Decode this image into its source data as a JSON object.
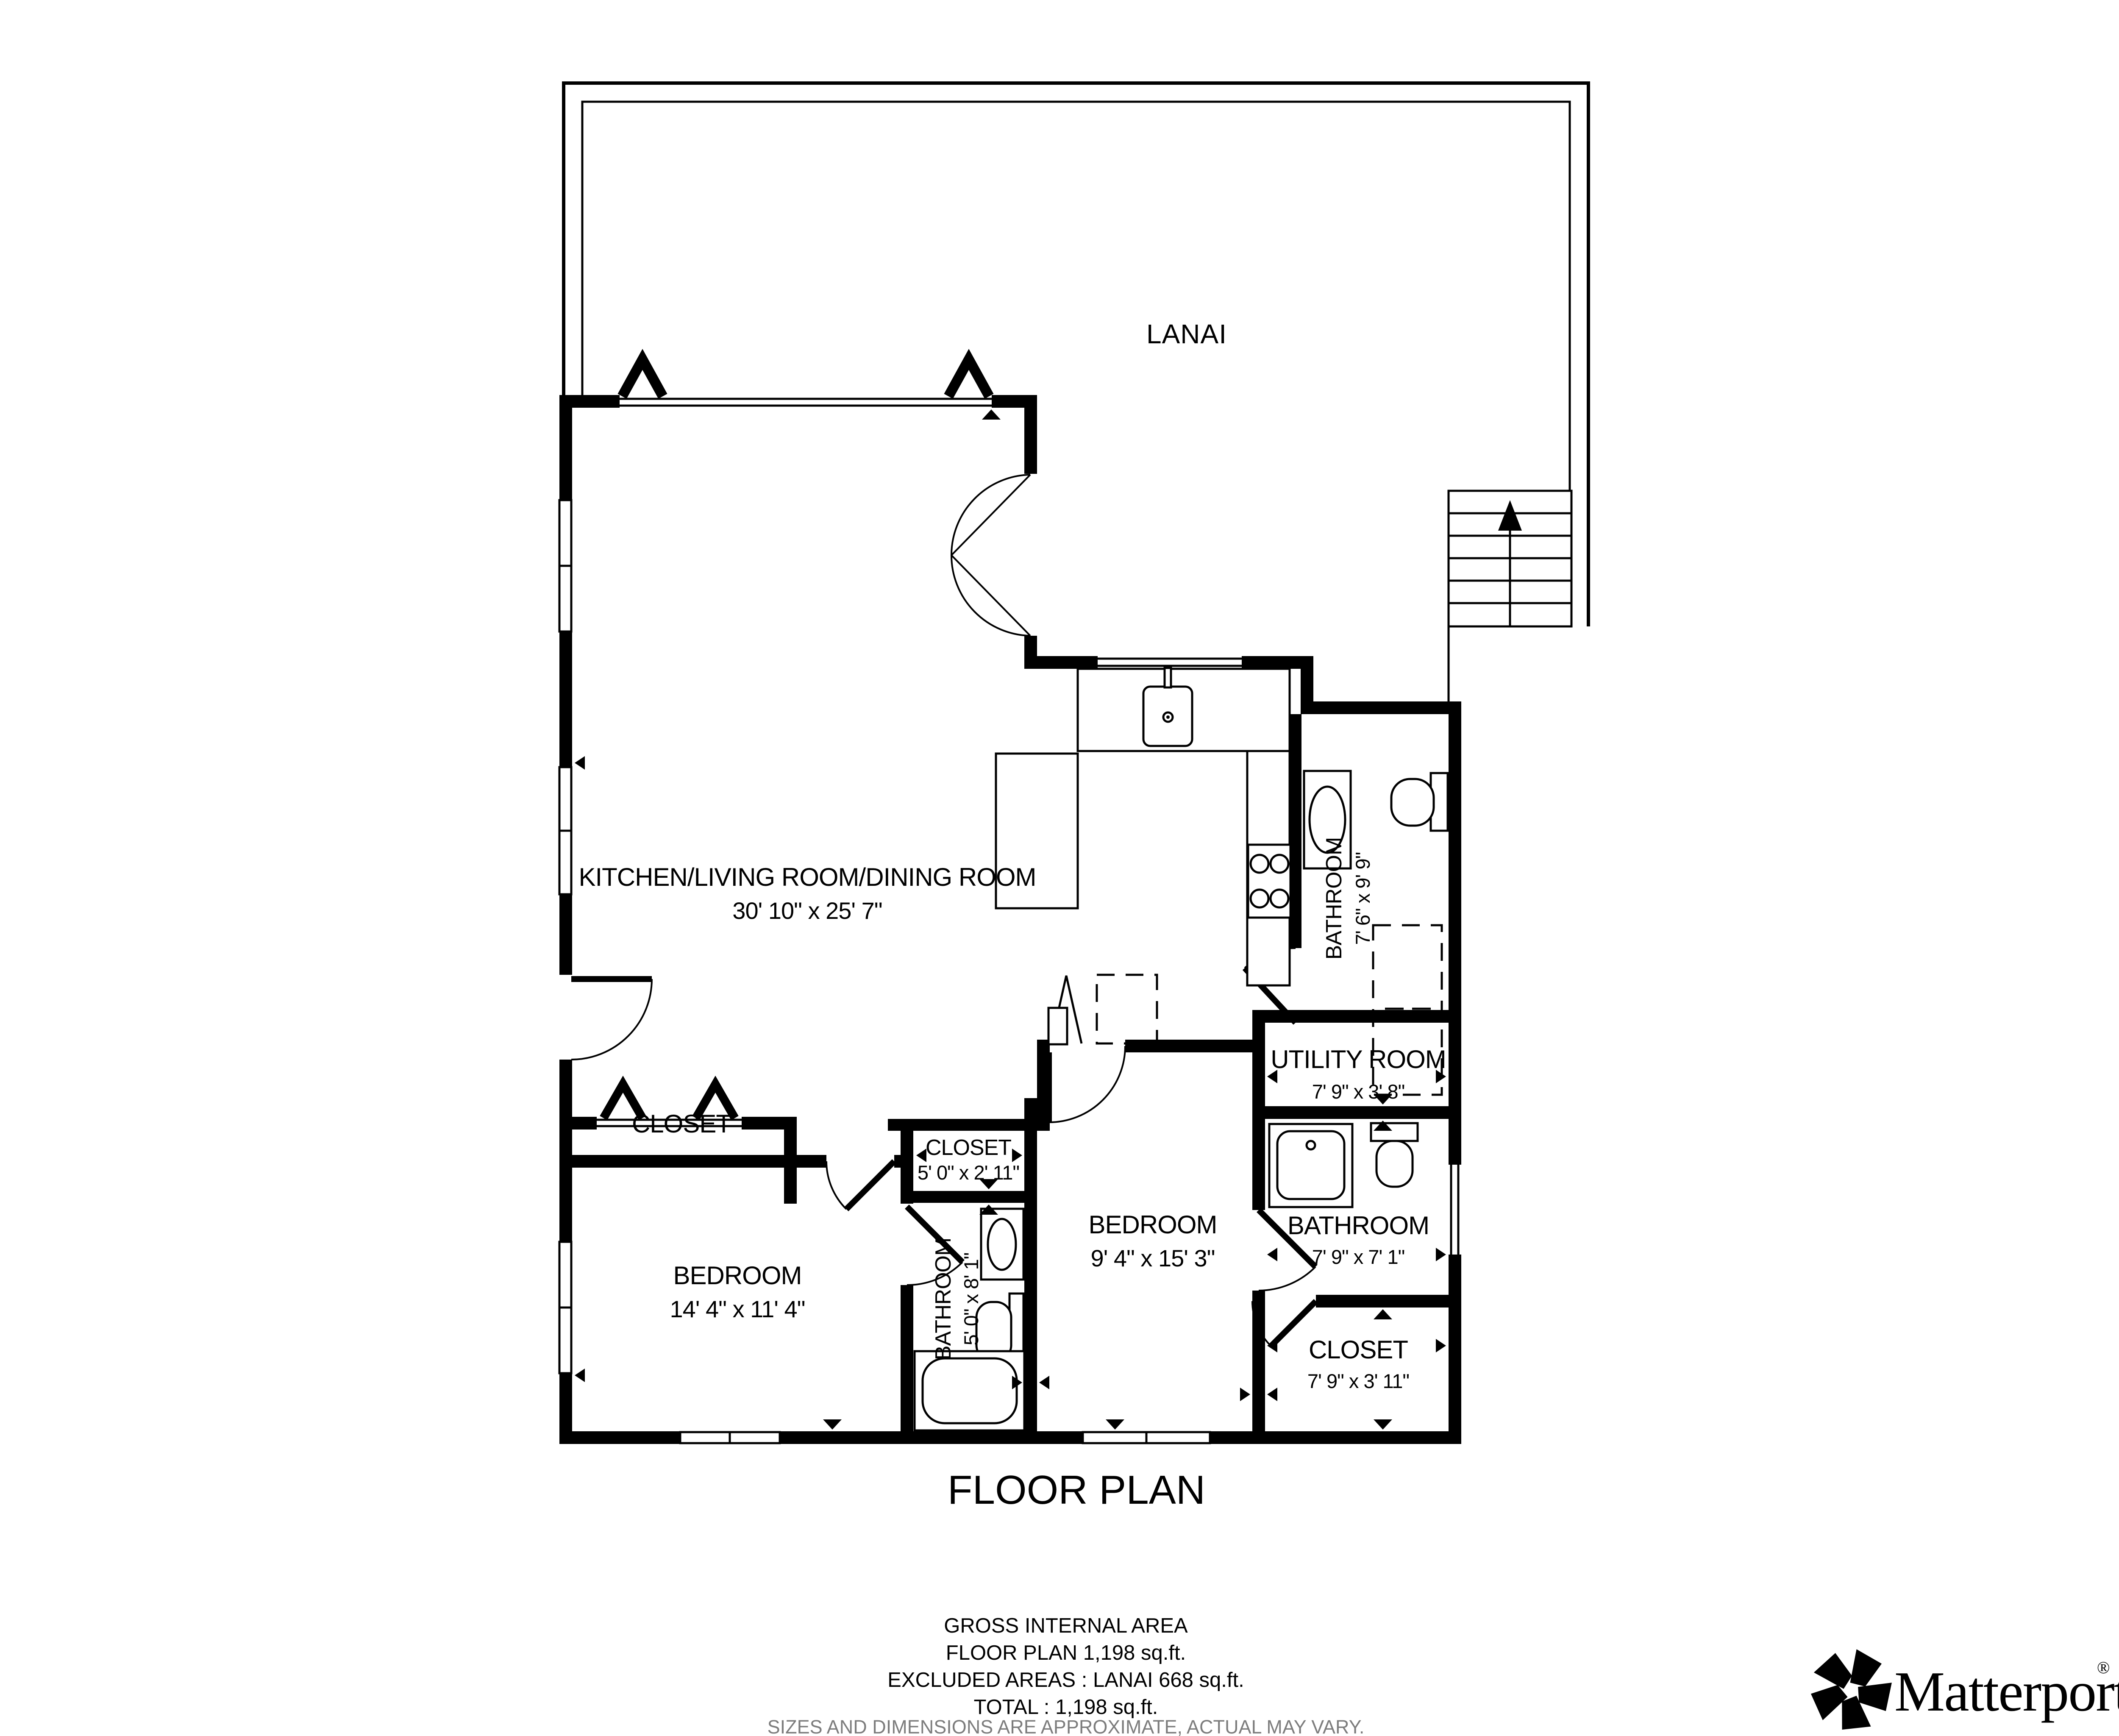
{
  "colors": {
    "ink": "#000000",
    "muted": "#7d7d7d",
    "background": "#ffffff"
  },
  "plan_title": "FLOOR PLAN",
  "rooms": {
    "lanai": {
      "name": "LANAI"
    },
    "kitchen_living": {
      "name": "KITCHEN/LIVING ROOM/DINING ROOM",
      "dims": "30' 10\" x 25' 7\""
    },
    "closet_living": {
      "name": "CLOSET"
    },
    "bedroom_left": {
      "name": "BEDROOM",
      "dims": "14' 4\" x 11' 4\""
    },
    "closet_small": {
      "name": "CLOSET",
      "dims": "5' 0\" x 2' 11\""
    },
    "bathroom_small": {
      "name": "BATHROOM",
      "dims": "5' 0\" x 8' 1\""
    },
    "bedroom_middle": {
      "name": "BEDROOM",
      "dims": "9' 4\" x 15' 3\""
    },
    "utility_room": {
      "name": "UTILITY ROOM",
      "dims": "7' 9\" x 3' 8\""
    },
    "bathroom_right": {
      "name": "BATHROOM",
      "dims": "7' 9\" x 7' 1\""
    },
    "closet_right": {
      "name": "CLOSET",
      "dims": "7' 9\" x 3' 11\""
    },
    "bathroom_top": {
      "name": "BATHROOM",
      "dims": "7' 6\" x 9' 9\""
    }
  },
  "footer": {
    "area_title": "GROSS INTERNAL AREA",
    "floor_plan_area": "FLOOR PLAN 1,198 sq.ft.",
    "excluded_areas": "EXCLUDED AREAS :  LANAI 668 sq.ft.",
    "total_area": "TOTAL :  1,198 sq.ft.",
    "disclaimer": "SIZES AND DIMENSIONS ARE APPROXIMATE, ACTUAL MAY VARY."
  },
  "brand": {
    "name": "Matterport",
    "registered": "®"
  }
}
